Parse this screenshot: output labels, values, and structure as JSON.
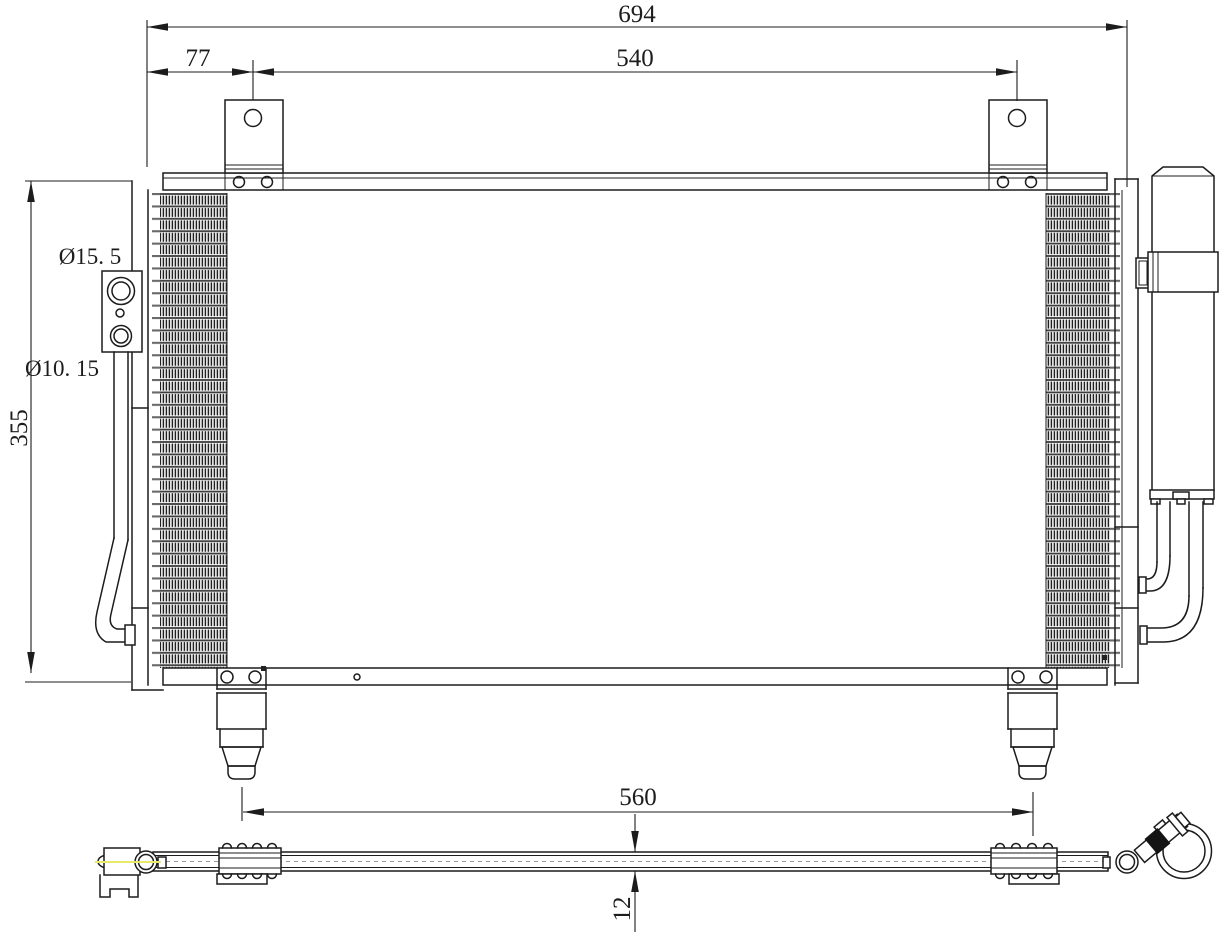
{
  "labels": {
    "overall_width": "694",
    "mount_hole_span": "540",
    "mount_hole_offset": "77",
    "core_height": "355",
    "large_port_diameter": "Ø15. 5",
    "small_port_diameter": "Ø10. 15",
    "foot_span": "560",
    "core_thickness": "12"
  },
  "colors": {
    "line": "#1c1c1c",
    "background": "#ffffff",
    "tube_line": "#6a6a6a",
    "fin_hatch": "#202020",
    "centerline_yellow": "#e9e96a",
    "clamp_pad": "#141414"
  }
}
